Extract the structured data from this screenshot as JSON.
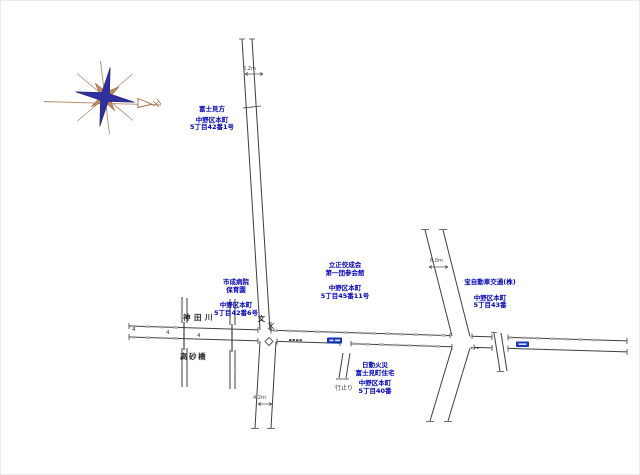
{
  "colors": {
    "label_blue": "#0000b4",
    "road_line": "#3f3f3f",
    "hatch_gray": "#a8a8a8",
    "badge_blue": "#1536b8",
    "compass_blue": "#2f2f9f",
    "compass_brown": "#a9795b"
  },
  "labels": {
    "fuji": {
      "name_lines": [
        "富士見方"
      ],
      "addr_lines": [
        "中野区本町",
        "5丁目42番1号"
      ]
    },
    "hoikuen": {
      "name_lines": [
        "市成病院",
        "保育園"
      ],
      "addr_lines": [
        "中野区本町",
        "5丁目42番6号"
      ]
    },
    "rissho": {
      "name_lines": [
        "立正佼成会",
        "第一団参会館"
      ],
      "addr_lines": [
        "中野区本町",
        "5丁目45番11号"
      ]
    },
    "takara": {
      "name_lines": [
        "宝自動車交通(株)"
      ],
      "addr_lines": [
        "中野区本町",
        "5丁目43番"
      ]
    },
    "nichido": {
      "name_lines": [
        "日動火災",
        "富士見町住宅"
      ],
      "addr_lines": [
        "中野区本町",
        "5丁目40番"
      ]
    }
  },
  "map_texts": {
    "river": "神田川",
    "bridge": "高砂橋",
    "dead_end": "行止り",
    "school_mark": "文"
  },
  "dimensions": {
    "north_road": "6.2m",
    "east_road": "6.0m",
    "south_road": "4.2m"
  },
  "width_markers": {
    "m1": "4",
    "m2": "4",
    "m3": "4"
  }
}
